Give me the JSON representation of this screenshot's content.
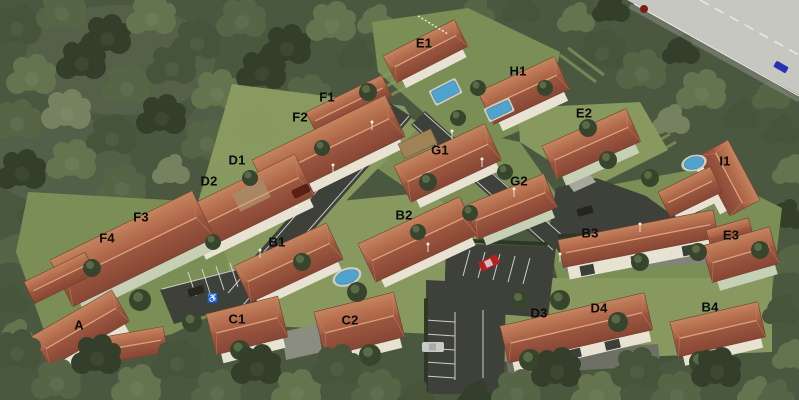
{
  "scene": {
    "type": "3d-aerial-site-plan-rendering"
  },
  "buildings": [
    {
      "label": "E1"
    },
    {
      "label": "H1"
    },
    {
      "label": "F1"
    },
    {
      "label": "F2"
    },
    {
      "label": "E2"
    },
    {
      "label": "G1"
    },
    {
      "label": "D1"
    },
    {
      "label": "I1"
    },
    {
      "label": "D2"
    },
    {
      "label": "G2"
    },
    {
      "label": "B2"
    },
    {
      "label": "F3"
    },
    {
      "label": "B3"
    },
    {
      "label": "E3"
    },
    {
      "label": "F4"
    },
    {
      "label": "B1"
    },
    {
      "label": "D4"
    },
    {
      "label": "B4"
    },
    {
      "label": "D3"
    },
    {
      "label": "C1"
    },
    {
      "label": "C2"
    },
    {
      "label": "A"
    }
  ],
  "icons": {
    "accessible_parking": "♿"
  },
  "palette": {
    "forest": "#4b5840",
    "grass": "#7c9057",
    "grass-light": "#8a9c61",
    "roof": "#a85e45",
    "roof-dark": "#8a4a36",
    "roof-light": "#c68a64",
    "asphalt": "#3e403a",
    "road-light": "#c7c7c1",
    "curb": "#dededa",
    "wall": "#e7e2d1",
    "wall-green": "#c6d0b4",
    "pool": "#4fa3cc",
    "pool-deck": "#ccccc0",
    "car-red": "#b81f1f",
    "car-blue": "#2733b5",
    "car-white": "#c9cac6",
    "label": "#0b0b0b"
  }
}
